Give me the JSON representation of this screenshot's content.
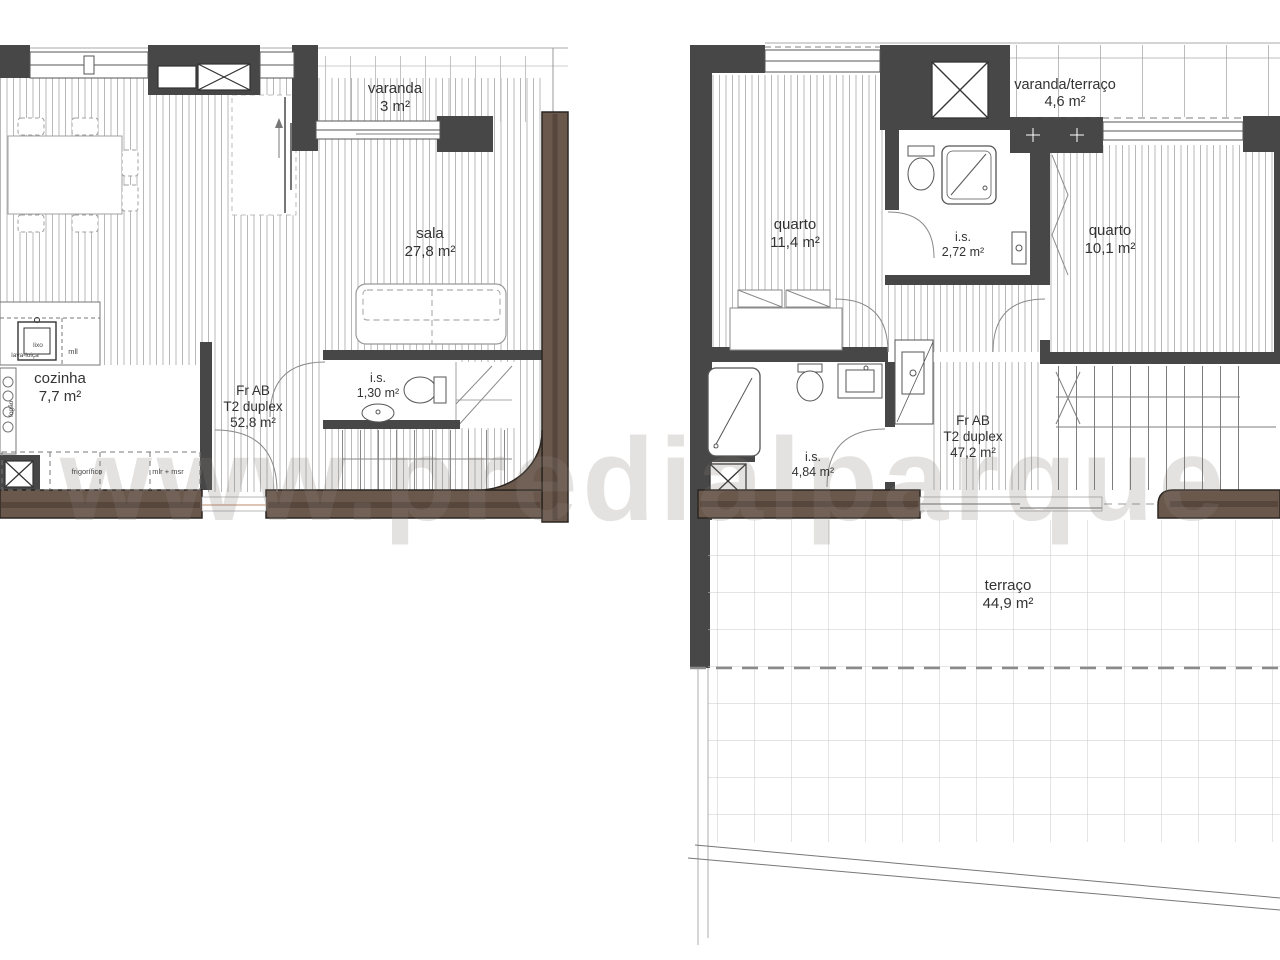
{
  "watermark": "www.predialparque",
  "colors": {
    "wall_dark": "#474747",
    "wall_brown": "#6b584d",
    "hatch_line": "#b8b8b8",
    "watermark_gray": "#8a8178"
  },
  "plan_left": {
    "unit": {
      "line1": "Fr AB",
      "line2": "T2 duplex",
      "area": "52,8 m²"
    },
    "rooms": [
      {
        "name": "varanda",
        "area": "3 m²"
      },
      {
        "name": "sala",
        "area": "27,8 m²"
      },
      {
        "name": "cozinha",
        "area": "7,7 m²"
      },
      {
        "name": "i.s.",
        "area": "1,30 m²"
      }
    ],
    "fixtures": {
      "lava_loica": "lava-loiça",
      "lixo": "lixo",
      "mll": "mll",
      "frigorifico": "frigorífico",
      "mlr_msr": "mlr + msr",
      "fogao": "fogão"
    }
  },
  "plan_right": {
    "unit": {
      "line1": "Fr AB",
      "line2": "T2 duplex",
      "area": "47,2 m²"
    },
    "rooms": [
      {
        "name": "quarto",
        "area": "11,4 m²"
      },
      {
        "name": "i.s.",
        "area": "2,72 m²"
      },
      {
        "name": "varanda/terraço",
        "area": "4,6 m²"
      },
      {
        "name": "quarto",
        "area": "10,1 m²"
      },
      {
        "name": "i.s.",
        "area": "4,84 m²"
      },
      {
        "name": "terraço",
        "area": "44,9 m²"
      }
    ]
  }
}
